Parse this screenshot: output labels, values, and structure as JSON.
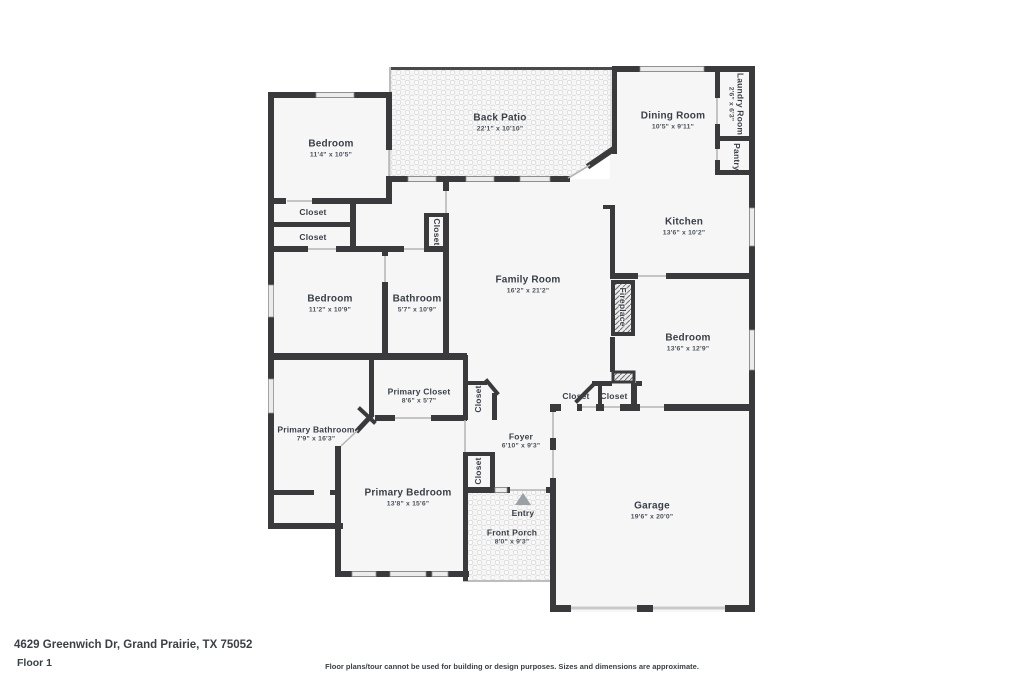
{
  "plan": {
    "address": "4629 Greenwich Dr, Grand Prairie, TX 75052",
    "floor_label": "Floor 1",
    "disclaimer": "Floor plans/tour cannot be used for building or design purposes. Sizes and dimensions are approximate.",
    "colors": {
      "wall": "#3a3a3c",
      "floor_fill": "#f6f6f7",
      "hatch_line": "#d6d6d6",
      "text": "#3b4048",
      "entry_arrow": "#9aa0a6"
    }
  },
  "rooms": {
    "bedroom_top_left": {
      "name": "Bedroom",
      "dims": "11'4\" x 10'5\""
    },
    "back_patio": {
      "name": "Back Patio",
      "dims": "22'1\" x 10'10\""
    },
    "dining_room": {
      "name": "Dining Room",
      "dims": "10'5\" x 9'11\""
    },
    "laundry_room": {
      "name": "Laundry Room",
      "dims": "2'6\" x 6'3\""
    },
    "pantry": {
      "name": "Pantry"
    },
    "kitchen": {
      "name": "Kitchen",
      "dims": "13'6\" x 10'2\""
    },
    "closet_upper": {
      "name": "Closet"
    },
    "closet_lower": {
      "name": "Closet"
    },
    "closet_hall": {
      "name": "Closet"
    },
    "bedroom_left": {
      "name": "Bedroom",
      "dims": "11'2\" x 10'9\""
    },
    "bathroom": {
      "name": "Bathroom",
      "dims": "5'7\" x 10'9\""
    },
    "family_room": {
      "name": "Family Room",
      "dims": "16'2\" x 21'2\""
    },
    "fireplace": {
      "name": "Fireplace"
    },
    "bedroom_right": {
      "name": "Bedroom",
      "dims": "13'6\" x 12'9\""
    },
    "primary_closet": {
      "name": "Primary Closet",
      "dims": "8'6\" x 5'7\""
    },
    "closet_angled": {
      "name": "Closet"
    },
    "closet_foyer_left": {
      "name": "Closet"
    },
    "closet_foyer_right": {
      "name": "Closet"
    },
    "primary_bathroom": {
      "name": "Primary Bathroom",
      "dims": "7'9\" x 16'3\""
    },
    "foyer": {
      "name": "Foyer",
      "dims": "6'10\" x 9'3\""
    },
    "primary_bedroom": {
      "name": "Primary Bedroom",
      "dims": "13'8\" x 15'6\""
    },
    "closet_primary_hall": {
      "name": "Closet"
    },
    "entry": {
      "name": "Entry"
    },
    "front_porch": {
      "name": "Front Porch",
      "dims": "8'0\" x 9'3\""
    },
    "garage": {
      "name": "Garage",
      "dims": "19'6\" x 20'0\""
    }
  }
}
